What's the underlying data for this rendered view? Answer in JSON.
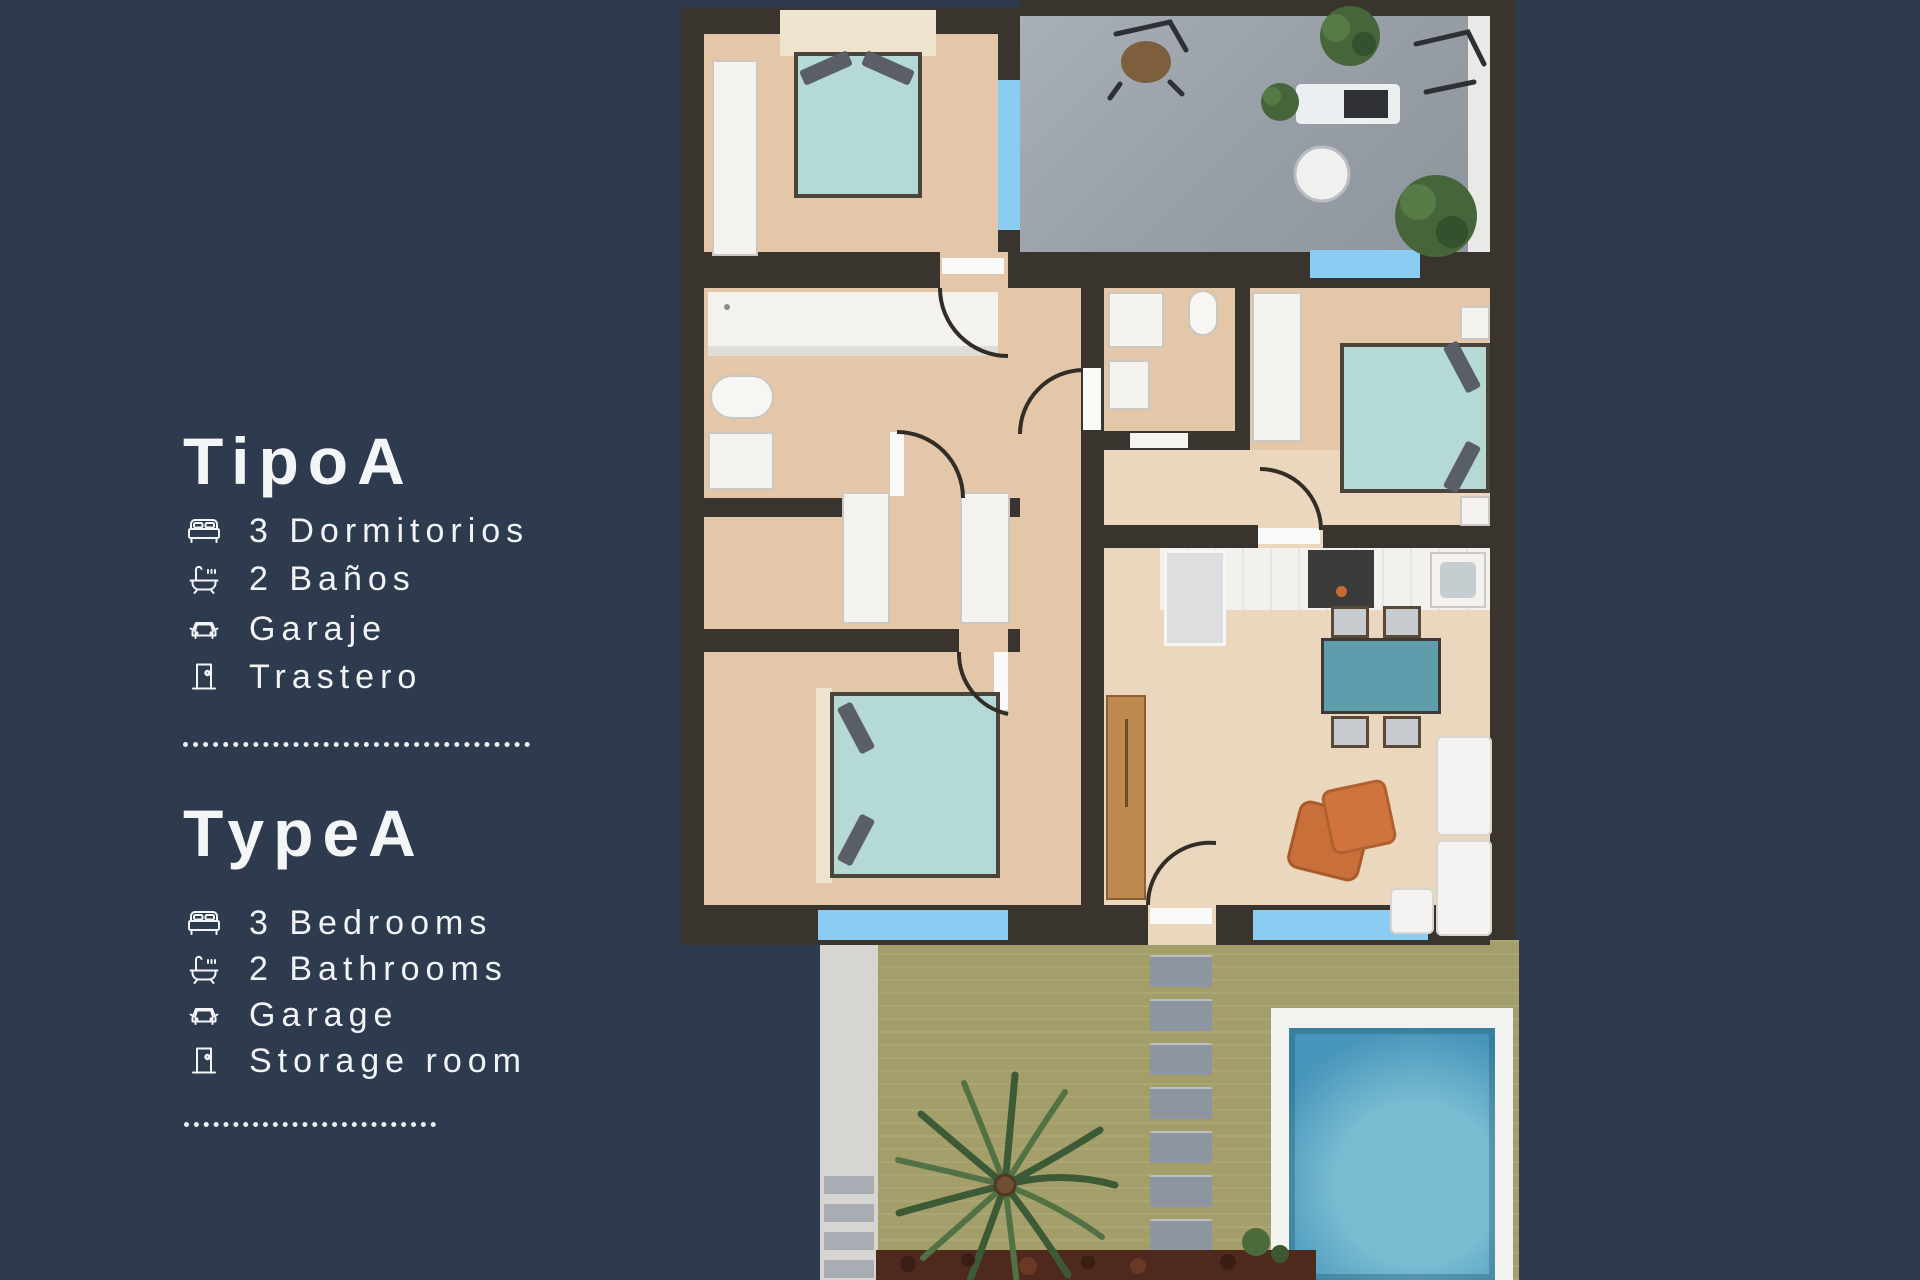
{
  "page": {
    "background_color": "#2e3a4e",
    "text_color": "#f1f3f5"
  },
  "panel": {
    "sections": [
      {
        "title": "TipoA",
        "features": [
          {
            "icon": "bed-icon",
            "label": "3 Dormitorios"
          },
          {
            "icon": "bathtub-icon",
            "label": "2 Baños"
          },
          {
            "icon": "car-icon",
            "label": "Garaje"
          },
          {
            "icon": "door-icon",
            "label": "Trastero"
          }
        ]
      },
      {
        "title": "TypeA",
        "features": [
          {
            "icon": "bed-icon",
            "label": "3 Bedrooms"
          },
          {
            "icon": "bathtub-icon",
            "label": "2 Bathrooms"
          },
          {
            "icon": "car-icon",
            "label": "Garage"
          },
          {
            "icon": "door-icon",
            "label": "Storage room"
          }
        ]
      }
    ]
  },
  "floorplan": {
    "type": "apartment-top-view",
    "rooms_visible": [
      "bedroom-1",
      "terrace",
      "bathroom-1",
      "bathroom-2",
      "bedroom-2",
      "kitchen",
      "living-dining-room",
      "hallway",
      "bedroom-3",
      "garden",
      "pool"
    ],
    "palette": {
      "wall": "#3a342e",
      "floor": "#e3c7a8",
      "floor_light": "#ead7bd",
      "terrace": "#9aa0a8",
      "garden": "#a49f6a",
      "window_blue": "#8bcdf2",
      "bed_teal": "#b5dad6",
      "table_teal": "#5e9dac",
      "pool_water": "#4795ba",
      "pool_deck": "#f2f2ef",
      "accent_orange": "#cf7440",
      "wood_door": "#bf8a50"
    }
  }
}
